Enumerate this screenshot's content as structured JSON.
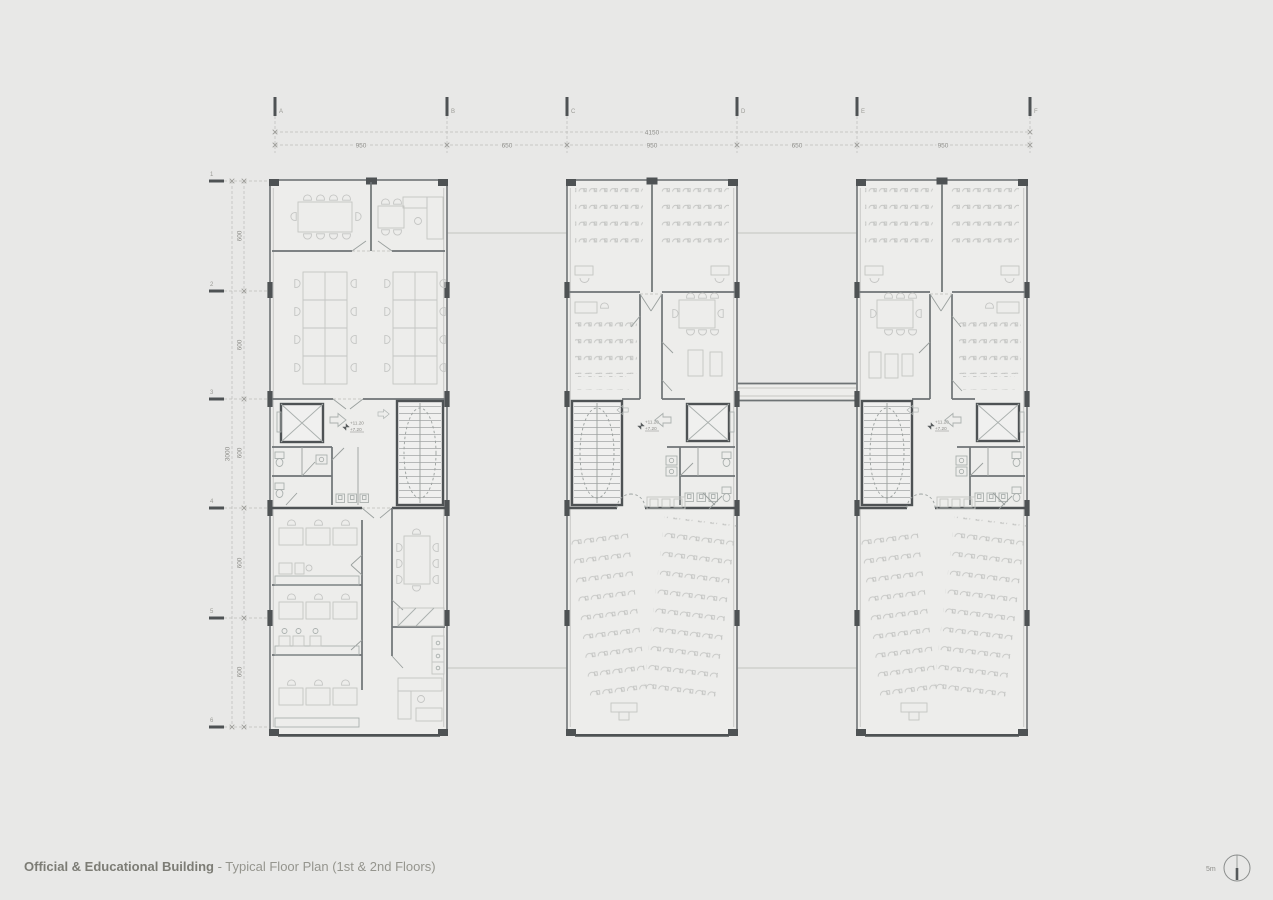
{
  "title": {
    "bold": "Official & Educational Building",
    "rest": " - Typical Floor Plan (1st & 2nd Floors)"
  },
  "grid": {
    "columns": [
      "A",
      "B",
      "C",
      "D",
      "E",
      "F"
    ],
    "column_dims": [
      "950",
      "650",
      "950",
      "650",
      "950"
    ],
    "overall_width": "4150",
    "rows": [
      "1",
      "2",
      "3",
      "4",
      "5",
      "6"
    ],
    "row_dims": [
      "600",
      "600",
      "600",
      "600",
      "600"
    ],
    "overall_height": "3000"
  },
  "levels": {
    "upper": "+11.20",
    "lower": "+7.20"
  },
  "scale": {
    "label": "5m"
  },
  "colors": {
    "background": "#e8e8e7",
    "floor": "#ededeb",
    "wall": "#4e5254",
    "furniture_line": "#c4c5c3",
    "dimension_text": "#8e8e8a"
  }
}
